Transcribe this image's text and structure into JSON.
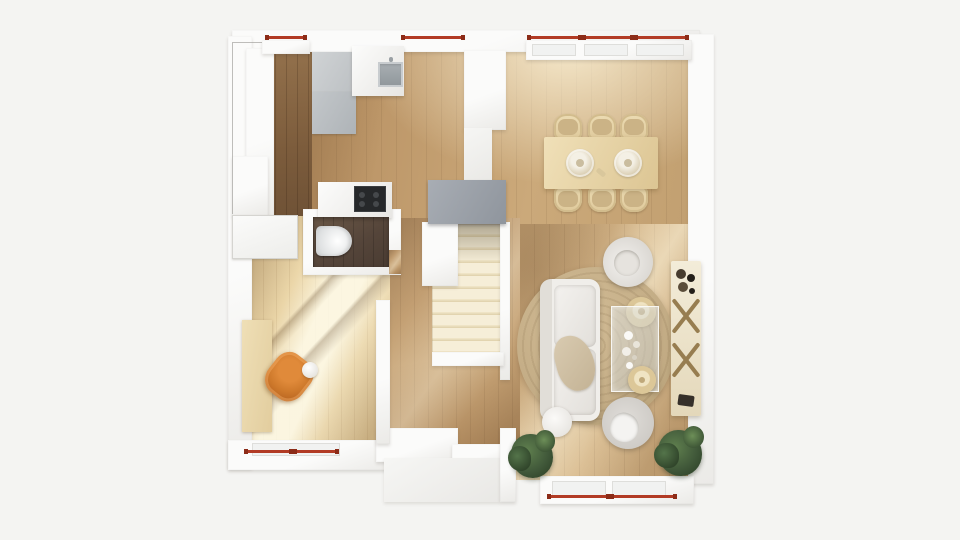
{
  "scene": {
    "kind": "architectural-floor-plan-3d-render",
    "view": "top-down",
    "rooms": [
      "kitchen",
      "dining-area",
      "living-room",
      "hallway",
      "bathroom",
      "study-room",
      "pantry-closet",
      "staircase",
      "entry-porch"
    ],
    "furniture": [
      "kitchen-sink",
      "cooktop",
      "gray-kitchen-cabinets",
      "white-counters",
      "dining-table",
      "six-dining-chairs",
      "two-dinner-plates",
      "sofa",
      "glass-coffee-table",
      "two-round-side-tables",
      "two-round-armchairs",
      "pouf",
      "round-rug",
      "console-table-x-legs",
      "two-potted-plants",
      "toilet",
      "desk",
      "orange-desk-chair",
      "white-wardrobe",
      "staircase-steps"
    ],
    "window_marker_count": 5
  },
  "palette": {
    "bg": "#f4f4f2",
    "wall": "#fbfbfa",
    "windowred": "#b23b25",
    "windowreddark": "#8c2c18",
    "oak": "#c9a678",
    "walnut": "#8a6746",
    "bathroomfloor": "#55453a",
    "stair": "#f3ead6",
    "landing": "#9aa0a8",
    "cooktop": "#26282a",
    "orange": "#cf7a2c",
    "orangedark": "#a9571a",
    "rug": "#c2ab84",
    "plant": "#41593a",
    "sofa": "#f0eeea",
    "tablecream": "#e8d6ac"
  }
}
